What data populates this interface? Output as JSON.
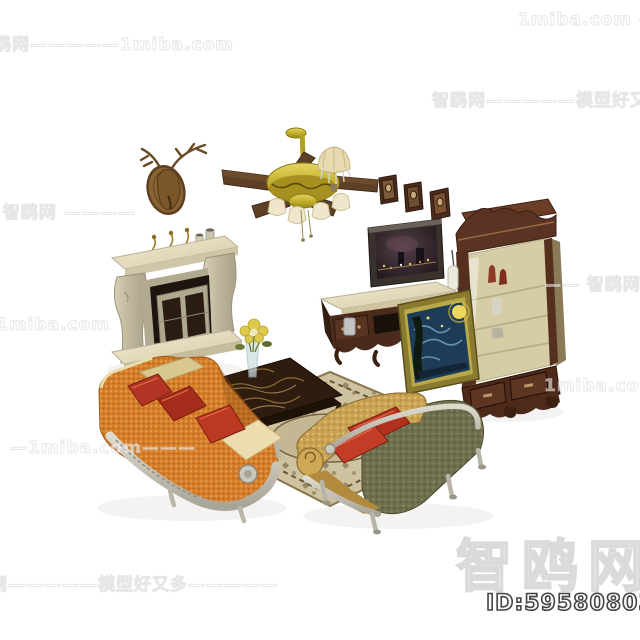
{
  "watermarks": {
    "logo_text": "智鸥网",
    "tiles": [
      {
        "text": "智鸥网—————1miba.com"
      },
      {
        "text": "1miba.com ——————"
      },
      {
        "text": "智鸥网—————模型好又多"
      },
      {
        "text": "———— 智鸥网 ————"
      },
      {
        "text": "———1miba.com"
      },
      {
        "text": "—— 智鸥网"
      },
      {
        "text": "1miba.com ———"
      },
      {
        "text": "—1miba.com———"
      },
      {
        "text": "智鸥网—————模型好又多—————"
      }
    ]
  },
  "product": {
    "id_text": "ID:595808035"
  },
  "palette": {
    "background": "#ffffff",
    "sofa_orange": "#d57f2a",
    "pillow_red": "#b23222",
    "chaise_gold": "#c9a252",
    "chaise_olive": "#6f6f4f",
    "frame_silver": "#c8c4b8",
    "fireplace_cream": "#e9e1c6",
    "wood_dark": "#54301e",
    "fan_brass": "#c7b42e",
    "blade_brown": "#5e4026",
    "marble_top": "#2e1d0e",
    "rug_beige": "#cdc3a0",
    "painting_blue": "#1e3c58",
    "painting_moon": "#ecd75e"
  }
}
